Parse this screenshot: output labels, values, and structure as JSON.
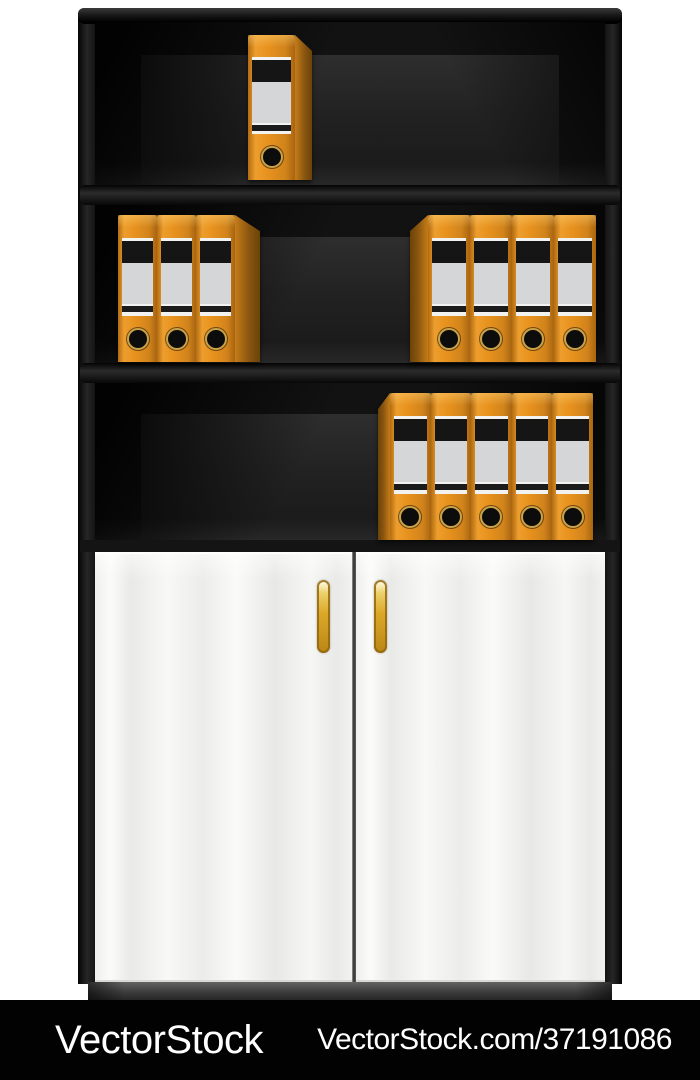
{
  "colors": {
    "cabinet_black": "#141414",
    "binder_orange": "#e8921e",
    "binder_side_dark": "#7a4e10",
    "label_gray": "#d4d6d8",
    "label_black": "#151515",
    "grommet_gold": "#c9a24a",
    "door_white": "#f7f7f5",
    "handle_gold": "#dca829",
    "watermark_bg": "#020202",
    "watermark_text": "#ffffff"
  },
  "cabinet": {
    "shelf_count": 3,
    "door_count": 2,
    "binder_total": 13,
    "binder_groups": [
      {
        "shelf": 1,
        "count": 1,
        "facing": "right"
      },
      {
        "shelf": 2,
        "count": 3,
        "facing": "right"
      },
      {
        "shelf": 2,
        "count": 4,
        "facing": "left"
      },
      {
        "shelf": 3,
        "count": 5,
        "facing": "left"
      }
    ]
  },
  "watermark": {
    "brand": "VectorStock",
    "url": "VectorStock.com/37191086"
  }
}
